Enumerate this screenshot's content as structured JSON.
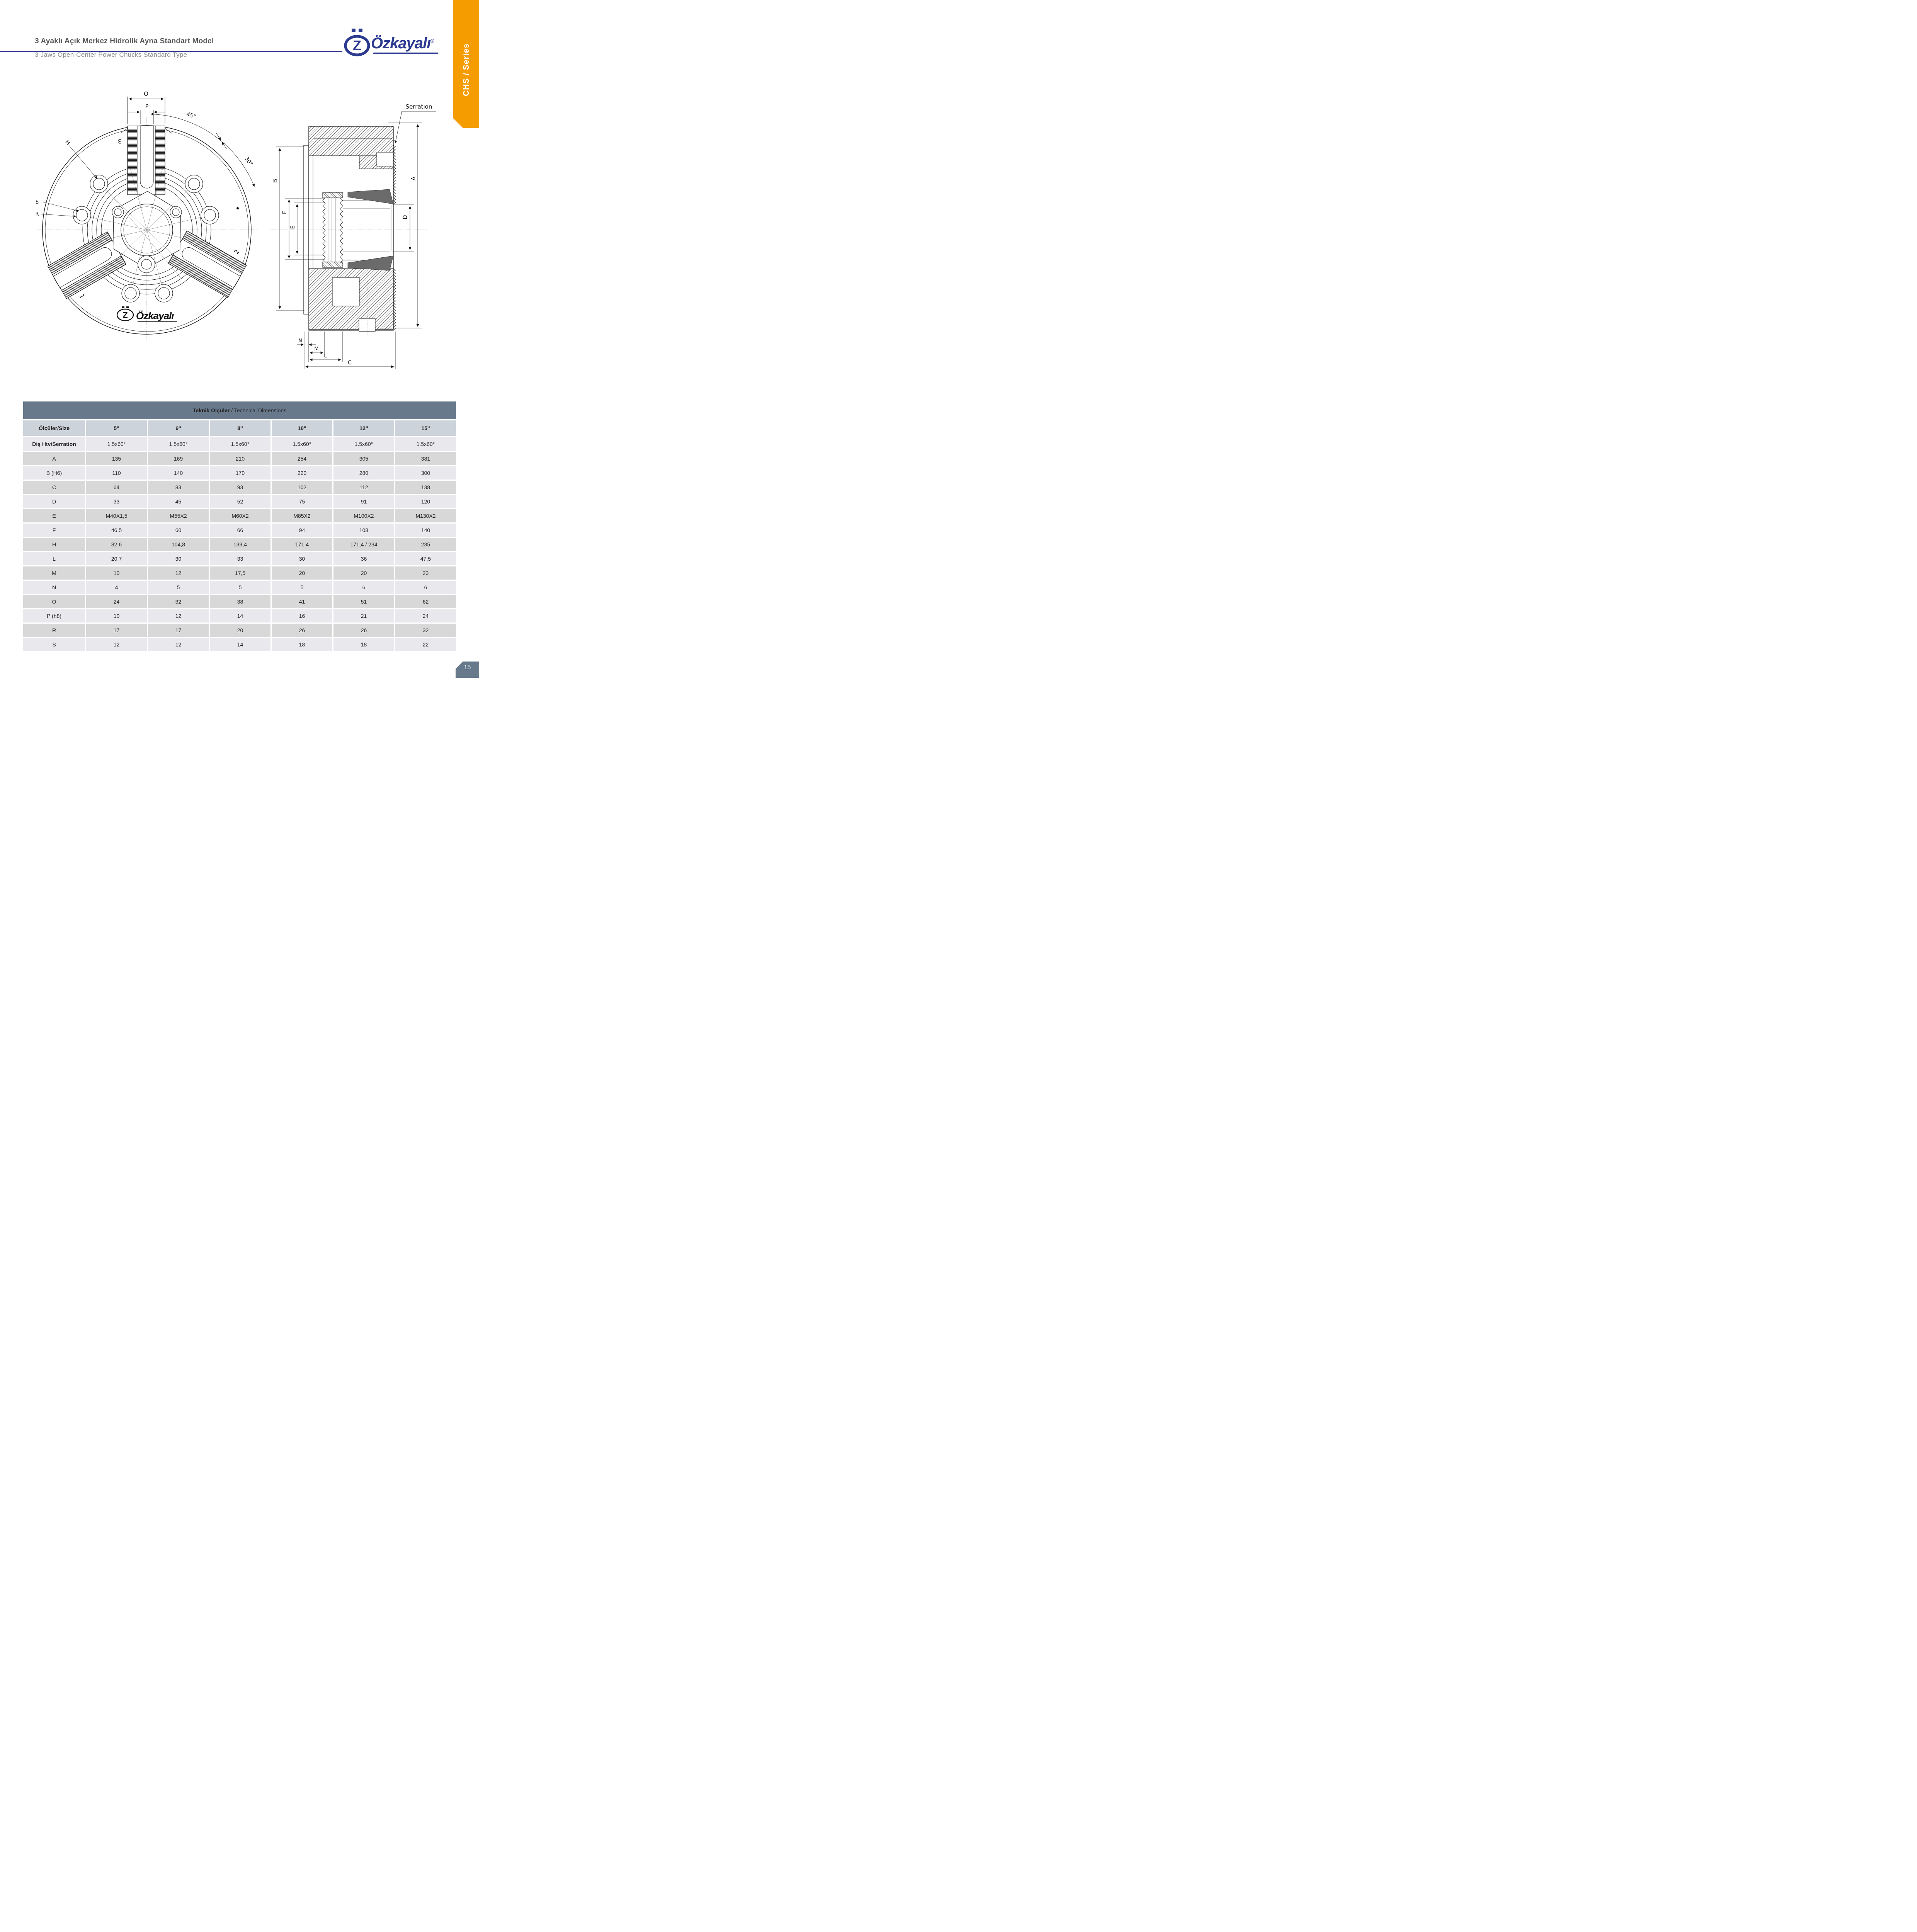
{
  "page": {
    "title_tr": "3 Ayaklı Açık Merkez Hidrolik Ayna Standart Model",
    "title_en": "3 Jaws Open-Center Power Chucks Standard Type",
    "page_number": "15"
  },
  "brand": {
    "name": "Özkayalı",
    "registered": "®",
    "mark_letter": "Z"
  },
  "series_tab": {
    "label": "CHS / Series"
  },
  "drawing": {
    "front": {
      "labels": {
        "o": "O",
        "p": "P",
        "angle45": "45°",
        "angle30": "30°",
        "h": "H",
        "s": "S",
        "r": "R",
        "jaw1": "1",
        "jaw2": "2",
        "jaw3": "3"
      },
      "stamp": "Özkayalı"
    },
    "section": {
      "labels": {
        "serration": "Serratıon",
        "a": "A",
        "b": "B",
        "c": "C",
        "d": "D",
        "e": "E",
        "f": "F",
        "l": "L",
        "m": "M",
        "n": "N"
      }
    }
  },
  "table": {
    "title_bold": "Teknik Ölçüler",
    "title_rest": " / Technical Dimensions",
    "columns": [
      "Ölçüler/Size",
      "5''",
      "6''",
      "8''",
      "10''",
      "12''",
      "15''"
    ],
    "serration_row": {
      "label": "Diş Htv/Serration",
      "values": [
        "1.5x60°",
        "1.5x60°",
        "1.5x60°",
        "1.5x60°",
        "1.5x60°",
        "1.5x60°"
      ]
    },
    "rows": [
      {
        "label": "A",
        "values": [
          "135",
          "169",
          "210",
          "254",
          "305",
          "381"
        ]
      },
      {
        "label": "B (H6)",
        "values": [
          "110",
          "140",
          "170",
          "220",
          "280",
          "300"
        ]
      },
      {
        "label": "C",
        "values": [
          "64",
          "83",
          "93",
          "102",
          "112",
          "138"
        ]
      },
      {
        "label": "D",
        "values": [
          "33",
          "45",
          "52",
          "75",
          "91",
          "120"
        ]
      },
      {
        "label": "E",
        "values": [
          "M40X1,5",
          "M55X2",
          "M60X2",
          "M85X2",
          "M100X2",
          "M130X2"
        ]
      },
      {
        "label": "F",
        "values": [
          "46,5",
          "60",
          "66",
          "94",
          "108",
          "140"
        ]
      },
      {
        "label": "H",
        "values": [
          "82,6",
          "104,8",
          "133,4",
          "171,4",
          "171,4 / 234",
          "235"
        ]
      },
      {
        "label": "L",
        "values": [
          "20,7",
          "30",
          "33",
          "30",
          "36",
          "47,5"
        ]
      },
      {
        "label": "M",
        "values": [
          "10",
          "12",
          "17,5",
          "20",
          "20",
          "23"
        ]
      },
      {
        "label": "N",
        "values": [
          "4",
          "5",
          "5",
          "5",
          "6",
          "6"
        ]
      },
      {
        "label": "O",
        "values": [
          "24",
          "32",
          "38",
          "41",
          "51",
          "62"
        ]
      },
      {
        "label": "P (h8)",
        "values": [
          "10",
          "12",
          "14",
          "16",
          "21",
          "24"
        ]
      },
      {
        "label": "R",
        "values": [
          "17",
          "17",
          "20",
          "26",
          "26",
          "32"
        ]
      },
      {
        "label": "S",
        "values": [
          "12",
          "12",
          "14",
          "18",
          "18",
          "22"
        ]
      }
    ]
  },
  "colors": {
    "accent_orange": "#f59c00",
    "slate_header": "#67798b",
    "navy_brand": "#2b3990",
    "row_dark": "#d8d8d8",
    "row_light": "#e9e9ed",
    "row_size": "#ccd3da"
  }
}
